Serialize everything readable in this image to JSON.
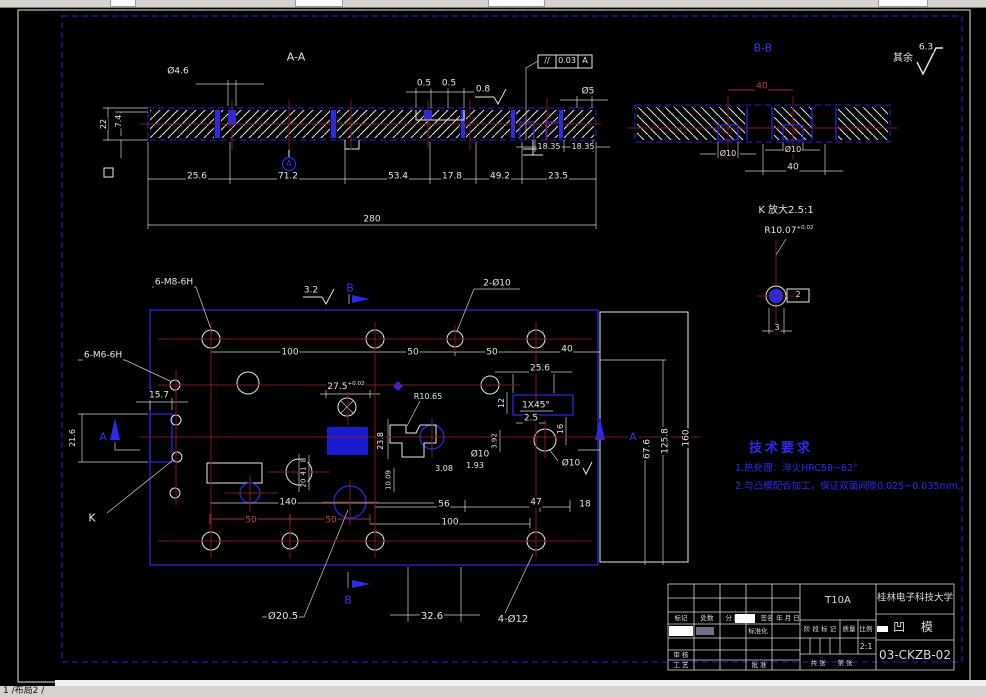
{
  "chrome": {
    "status_tabs": "1 /布局2 /"
  },
  "tech_req": {
    "title": "技术要求",
    "lines": [
      "1.热处理：淬火HRC58~62°",
      "2.与凸模配合加工，保证双面间隙0.025~0.035mm."
    ]
  },
  "title_block": {
    "school": "桂林电子科技大学",
    "material": "T10A",
    "part_name": "凹 模",
    "drawing_no": "03-CKZB-02",
    "scale": "2:1",
    "labels": {
      "mark": "标记",
      "count": "处数",
      "zone": "分 区",
      "sign": "签名",
      "date": "年 月 日",
      "standard": "标准化",
      "check": "审 核",
      "process": "工 艺",
      "approve": "批 准",
      "stage": "阶 段 标 记",
      "weight": "质量",
      "scale_lbl": "比例",
      "sheet": "共 张",
      "page": "第 张"
    }
  },
  "labels": [
    {
      "t": "A-A",
      "x": 296,
      "y": 57,
      "fs": 11
    },
    {
      "t": "Ø4.6",
      "x": 178,
      "y": 72,
      "fs": 9
    },
    {
      "t": "0.5",
      "x": 424,
      "y": 84,
      "fs": 9
    },
    {
      "t": "0.5",
      "x": 449,
      "y": 84,
      "fs": 9
    },
    {
      "t": "0.8",
      "x": 483,
      "y": 90,
      "fs": 9
    },
    {
      "t": "Ø5",
      "x": 588,
      "y": 92,
      "fs": 9
    },
    {
      "t": "18.35",
      "x": 549,
      "y": 147,
      "fs": 8
    },
    {
      "t": "18.35",
      "x": 583,
      "y": 147,
      "fs": 8
    },
    {
      "t": "22",
      "x": 104,
      "y": 124,
      "fs": 8,
      "rot": -90
    },
    {
      "t": "7.4",
      "x": 119,
      "y": 121,
      "fs": 8,
      "rot": -90
    },
    {
      "t": "25.6",
      "x": 197,
      "y": 177,
      "fs": 9
    },
    {
      "t": "71.2",
      "x": 288,
      "y": 177,
      "fs": 9
    },
    {
      "t": "53.4",
      "x": 398,
      "y": 177,
      "fs": 9
    },
    {
      "t": "17.8",
      "x": 452,
      "y": 177,
      "fs": 9
    },
    {
      "t": "49.2",
      "x": 500,
      "y": 177,
      "fs": 9
    },
    {
      "t": "23.5",
      "x": 558,
      "y": 177,
      "fs": 9
    },
    {
      "t": "280",
      "x": 372,
      "y": 220,
      "fs": 9
    },
    {
      "t": "A",
      "x": 289,
      "y": 164,
      "fs": 8,
      "c": "b"
    },
    {
      "t": "//",
      "x": 547,
      "y": 61,
      "fs": 8
    },
    {
      "t": "0.03",
      "x": 567,
      "y": 61,
      "fs": 8
    },
    {
      "t": "A",
      "x": 585,
      "y": 61,
      "fs": 8
    },
    {
      "t": "B-B",
      "x": 763,
      "y": 48,
      "fs": 11,
      "c": "b"
    },
    {
      "t": "其余",
      "x": 903,
      "y": 59,
      "fs": 10
    },
    {
      "t": "6.3",
      "x": 926,
      "y": 48,
      "fs": 9
    },
    {
      "t": "40",
      "x": 762,
      "y": 87,
      "fs": 9,
      "c": "r"
    },
    {
      "t": "Ø10",
      "x": 728,
      "y": 154,
      "fs": 8
    },
    {
      "t": "Ø10",
      "x": 793,
      "y": 150,
      "fs": 8
    },
    {
      "t": "40",
      "x": 793,
      "y": 168,
      "fs": 9
    },
    {
      "t": "K 放大2.5:1",
      "x": 786,
      "y": 211,
      "fs": 10
    },
    {
      "t": "R10.07",
      "x": 789,
      "y": 231,
      "fs": 9,
      "sup": "+0.02"
    },
    {
      "t": "2",
      "x": 798,
      "y": 295,
      "fs": 8
    },
    {
      "t": "3",
      "x": 777,
      "y": 328,
      "fs": 8
    },
    {
      "t": "6-M8-6H",
      "x": 174,
      "y": 283,
      "fs": 9
    },
    {
      "t": "3.2",
      "x": 311,
      "y": 291,
      "fs": 9
    },
    {
      "t": "B",
      "x": 350,
      "y": 288,
      "fs": 11,
      "c": "b"
    },
    {
      "t": "2-Ø10",
      "x": 497,
      "y": 284,
      "fs": 9
    },
    {
      "t": "100",
      "x": 290,
      "y": 353,
      "fs": 9
    },
    {
      "t": "50",
      "x": 413,
      "y": 353,
      "fs": 9
    },
    {
      "t": "50",
      "x": 492,
      "y": 353,
      "fs": 9
    },
    {
      "t": "40",
      "x": 567,
      "y": 350,
      "fs": 9
    },
    {
      "t": "6-M6-6H",
      "x": 103,
      "y": 356,
      "fs": 9
    },
    {
      "t": "15.7",
      "x": 159,
      "y": 396,
      "fs": 9
    },
    {
      "t": "21.6",
      "x": 73,
      "y": 438,
      "fs": 8,
      "rot": -90
    },
    {
      "t": "A",
      "x": 103,
      "y": 437,
      "fs": 11,
      "c": "b"
    },
    {
      "t": "A",
      "x": 633,
      "y": 437,
      "fs": 11,
      "c": "b"
    },
    {
      "t": "K",
      "x": 92,
      "y": 518,
      "fs": 11
    },
    {
      "t": "27.5",
      "x": 346,
      "y": 387,
      "fs": 9,
      "sup": "+0.02"
    },
    {
      "t": "R10.65",
      "x": 428,
      "y": 397,
      "fs": 8
    },
    {
      "t": "23.8",
      "x": 381,
      "y": 441,
      "fs": 8,
      "rot": -90
    },
    {
      "t": "12",
      "x": 502,
      "y": 403,
      "fs": 8,
      "rot": -90
    },
    {
      "t": "1X45°",
      "x": 536,
      "y": 406,
      "fs": 9
    },
    {
      "t": "2.5",
      "x": 531,
      "y": 419,
      "fs": 9
    },
    {
      "t": "25.6",
      "x": 540,
      "y": 369,
      "fs": 9
    },
    {
      "t": "16",
      "x": 561,
      "y": 429,
      "fs": 8,
      "rot": -90
    },
    {
      "t": "Ø10",
      "x": 571,
      "y": 464,
      "fs": 9
    },
    {
      "t": "Ø10",
      "x": 480,
      "y": 455,
      "fs": 9
    },
    {
      "t": "1.93",
      "x": 475,
      "y": 466,
      "fs": 8
    },
    {
      "t": "3.08",
      "x": 444,
      "y": 469,
      "fs": 8
    },
    {
      "t": "3.92",
      "x": 495,
      "y": 441,
      "fs": 7,
      "rot": -90
    },
    {
      "t": "10.09",
      "x": 389,
      "y": 480,
      "fs": 7,
      "rot": -90
    },
    {
      "t": "8",
      "x": 304,
      "y": 460,
      "fs": 7,
      "rot": -90
    },
    {
      "t": "41",
      "x": 304,
      "y": 471,
      "fs": 7,
      "rot": -90
    },
    {
      "t": "20",
      "x": 304,
      "y": 483,
      "fs": 7,
      "rot": -90
    },
    {
      "t": "67.6",
      "x": 648,
      "y": 449,
      "fs": 9,
      "rot": -90
    },
    {
      "t": "125.8",
      "x": 666,
      "y": 441,
      "fs": 9,
      "rot": -90
    },
    {
      "t": "160",
      "x": 687,
      "y": 438,
      "fs": 9,
      "rot": -90
    },
    {
      "t": "56",
      "x": 444,
      "y": 505,
      "fs": 9
    },
    {
      "t": "47",
      "x": 536,
      "y": 503,
      "fs": 9
    },
    {
      "t": "18",
      "x": 585,
      "y": 505,
      "fs": 9
    },
    {
      "t": "140",
      "x": 288,
      "y": 503,
      "fs": 9
    },
    {
      "t": "50",
      "x": 251,
      "y": 521,
      "fs": 9,
      "c": "r"
    },
    {
      "t": "50",
      "x": 331,
      "y": 521,
      "fs": 9,
      "c": "r"
    },
    {
      "t": "100",
      "x": 450,
      "y": 523,
      "fs": 9
    },
    {
      "t": "Ø20.5",
      "x": 283,
      "y": 617,
      "fs": 10
    },
    {
      "t": "32.6",
      "x": 432,
      "y": 617,
      "fs": 10
    },
    {
      "t": "4-Ø12",
      "x": 513,
      "y": 620,
      "fs": 10
    },
    {
      "t": "B",
      "x": 348,
      "y": 600,
      "fs": 11,
      "c": "b"
    }
  ]
}
